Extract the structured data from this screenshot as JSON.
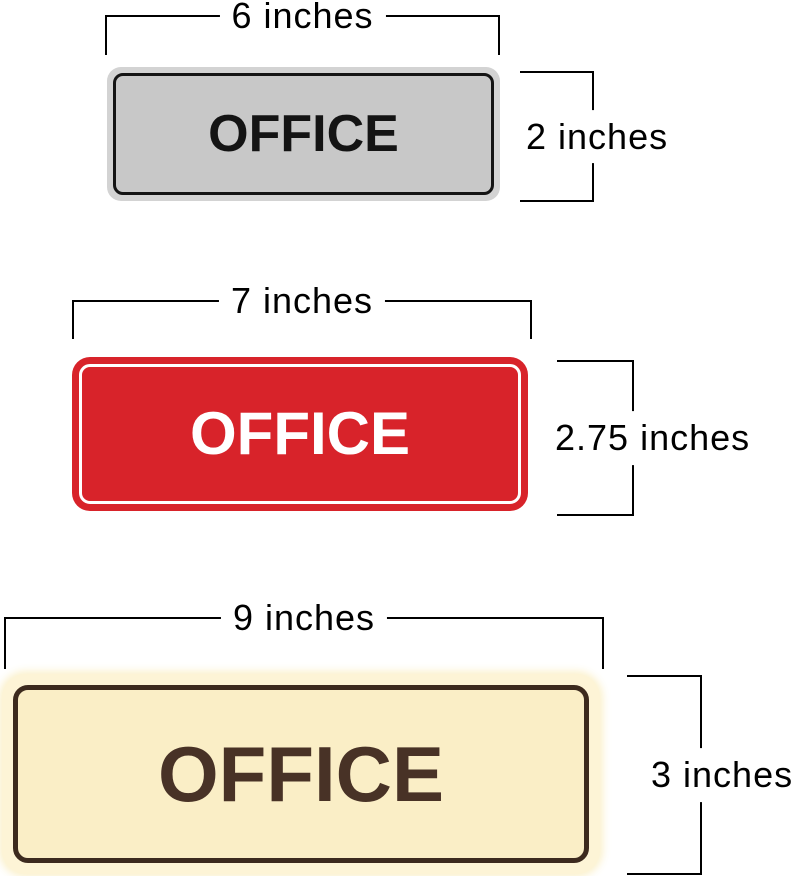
{
  "diagram": {
    "background": "#ffffff",
    "annotation_line_color": "#000000",
    "annotation_text_color": "#000000",
    "signs": [
      {
        "name": "gray-office-sign",
        "text": "OFFICE",
        "width_label": "6 inches",
        "height_label": "2 inches",
        "colors": {
          "outer": "#d3d3d3",
          "face": "#c8c8c8",
          "border": "#141414",
          "text": "#141414"
        }
      },
      {
        "name": "red-office-sign",
        "text": "OFFICE",
        "width_label": "7 inches",
        "height_label": "2.75 inches",
        "colors": {
          "outer": "#d8232a",
          "face": "#d8232a",
          "border": "#ffffff",
          "text": "#ffffff"
        }
      },
      {
        "name": "cream-office-sign",
        "text": "OFFICE",
        "width_label": "9 inches",
        "height_label": "3 inches",
        "colors": {
          "outer": "#fdf4d6",
          "face": "#faeec6",
          "border": "#3c2a1e",
          "text": "#483226"
        }
      }
    ]
  }
}
